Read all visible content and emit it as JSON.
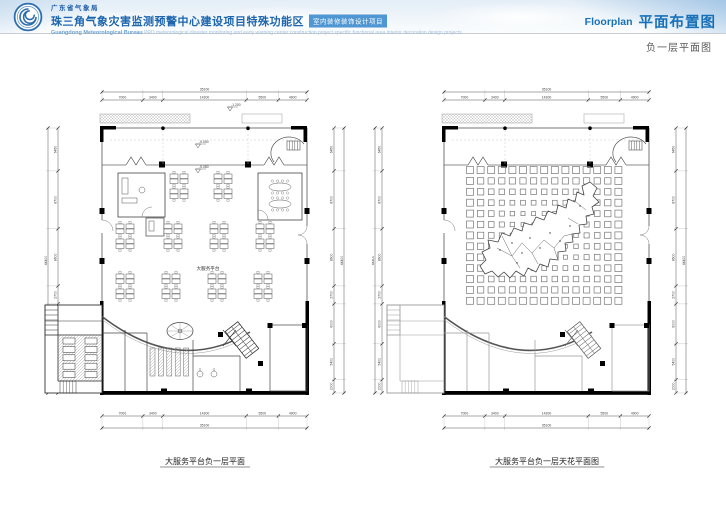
{
  "header": {
    "bureau_cn": "广东省气象局",
    "project_cn": "珠三角气象灾害监测预警中心建设项目特殊功能区",
    "badge": "室内装修装饰设计项目",
    "bureau_en": "Guangdong Meteorological Bureau",
    "project_en": "PRD meteorological disaster monitoring and early warning center construction project specific functional area interior decoration design projects",
    "page_type_en": "Floorplan",
    "page_type_cn": "平面布置图",
    "subtitle": "负一层平面图",
    "accent_color": "#1871b8",
    "badge_color": "#4f96d2"
  },
  "plans": {
    "left": {
      "caption": "大服务平台负一层平面",
      "room_label": "大服务平台",
      "elevations": [
        "-1.200",
        "-5.050",
        "-5.080"
      ],
      "dims_horiz": {
        "total": "35100",
        "segments": [
          "7000",
          "3400",
          "14300",
          "5500",
          "4900"
        ]
      },
      "dims_vert": {
        "total": "44400",
        "segments": [
          "6450",
          "8700",
          "8600",
          "2700",
          "6000",
          "5400",
          "2000"
        ]
      }
    },
    "right": {
      "caption": "大服务平台负一层天花平面图",
      "dims_horiz": {
        "total": "35100",
        "segments": [
          "7000",
          "3400",
          "14300",
          "5500",
          "4900"
        ]
      },
      "dims_vert": {
        "total": "44400",
        "segments": [
          "6450",
          "8700",
          "8600",
          "2700",
          "6000",
          "5400",
          "2000"
        ]
      }
    }
  }
}
